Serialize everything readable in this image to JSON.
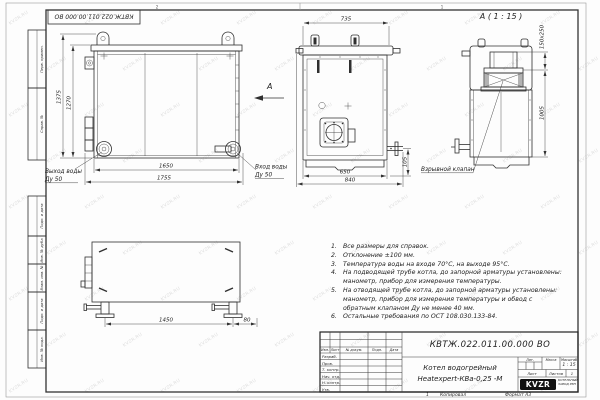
{
  "watermark": {
    "text": "KVZR.RU"
  },
  "sheet": {
    "stamp_top": "КВТЖ.022.011.00.000 ВО",
    "zone_left": "2",
    "zone_right": "1",
    "margin_labels": [
      "Перв. примен.",
      "Справ. №",
      "Подп. и дата",
      "Инв. № дубл.",
      "Взам. инв. №",
      "Подп. и дата",
      "Инв. № подл."
    ]
  },
  "front_view": {
    "dim_height_outer": "1375",
    "dim_height_inner": "1270",
    "dim_width_inner": "1650",
    "dim_width_outer": "1755",
    "label_outlet_line1": "Выход воды",
    "label_outlet_line2": "Ду 50",
    "label_inlet_line1": "Вход воды",
    "label_inlet_line2": "Ду 50",
    "view_arrow_label": "А"
  },
  "side_view": {
    "dim_top": "735",
    "dim_bottom_inner": "650",
    "dim_bottom_outer": "840",
    "dim_pipe_height": "105"
  },
  "detail_view": {
    "title": "А ( 1 : 15 )",
    "dim_valve": "150x250",
    "dim_height": "1005",
    "label_valve": "Взрывной клапан"
  },
  "plan_view": {
    "dim_span": "1450",
    "dim_offset": "80"
  },
  "notes": [
    {
      "num": "1.",
      "text": "Все размеры для справок."
    },
    {
      "num": "2.",
      "text": "Отклонение ±100 мм."
    },
    {
      "num": "3.",
      "text": "Температура воды на входе 70°С, на выходе 95°С."
    },
    {
      "num": "4.",
      "text": "На подводящей трубе котла, до запорной арматуры установлены: манометр, прибор для измерения температуры."
    },
    {
      "num": "5.",
      "text": "На отводящей трубе котла, до запорной арматуры установлены: манометр, прибор для измерения температуры и обвод с обратным клапаном Ду не менее 40 мм."
    },
    {
      "num": "6.",
      "text": "Остальные требования по ОСТ 108.030.133-84."
    }
  ],
  "title_block": {
    "designation": "КВТЖ.022.011.00.000 ВО",
    "doc_name_line1": "Котел водогрейный",
    "doc_name_line2": "Heatexpert-КВа-0,25 -М",
    "col_izm": "Изм.",
    "col_list": "Лист",
    "col_docnum": "№ докум.",
    "col_podp": "Подп.",
    "col_data": "Дата",
    "rows": [
      "Разраб.",
      "Пров.",
      "Т. контр.",
      "Нач. отд.",
      "Н. контр.",
      "Утв."
    ],
    "lit": "Лит.",
    "mass": "Масса",
    "scale": "Масштаб",
    "scale_value": "1 : 15",
    "sheet": "Лист",
    "sheets": "Листов",
    "sheets_value": "1",
    "logo": "KVZR",
    "company_line1": "КОТЕЛЬНЫЙ",
    "company_line2": "ЗАВОД РЭП",
    "footer_num": "1",
    "footer_copy": "Копировал",
    "footer_format": "Формат А3"
  },
  "colors": {
    "line": "#2f2f2f",
    "watermark": "#bdbdbd",
    "logo_bg": "#111111"
  }
}
